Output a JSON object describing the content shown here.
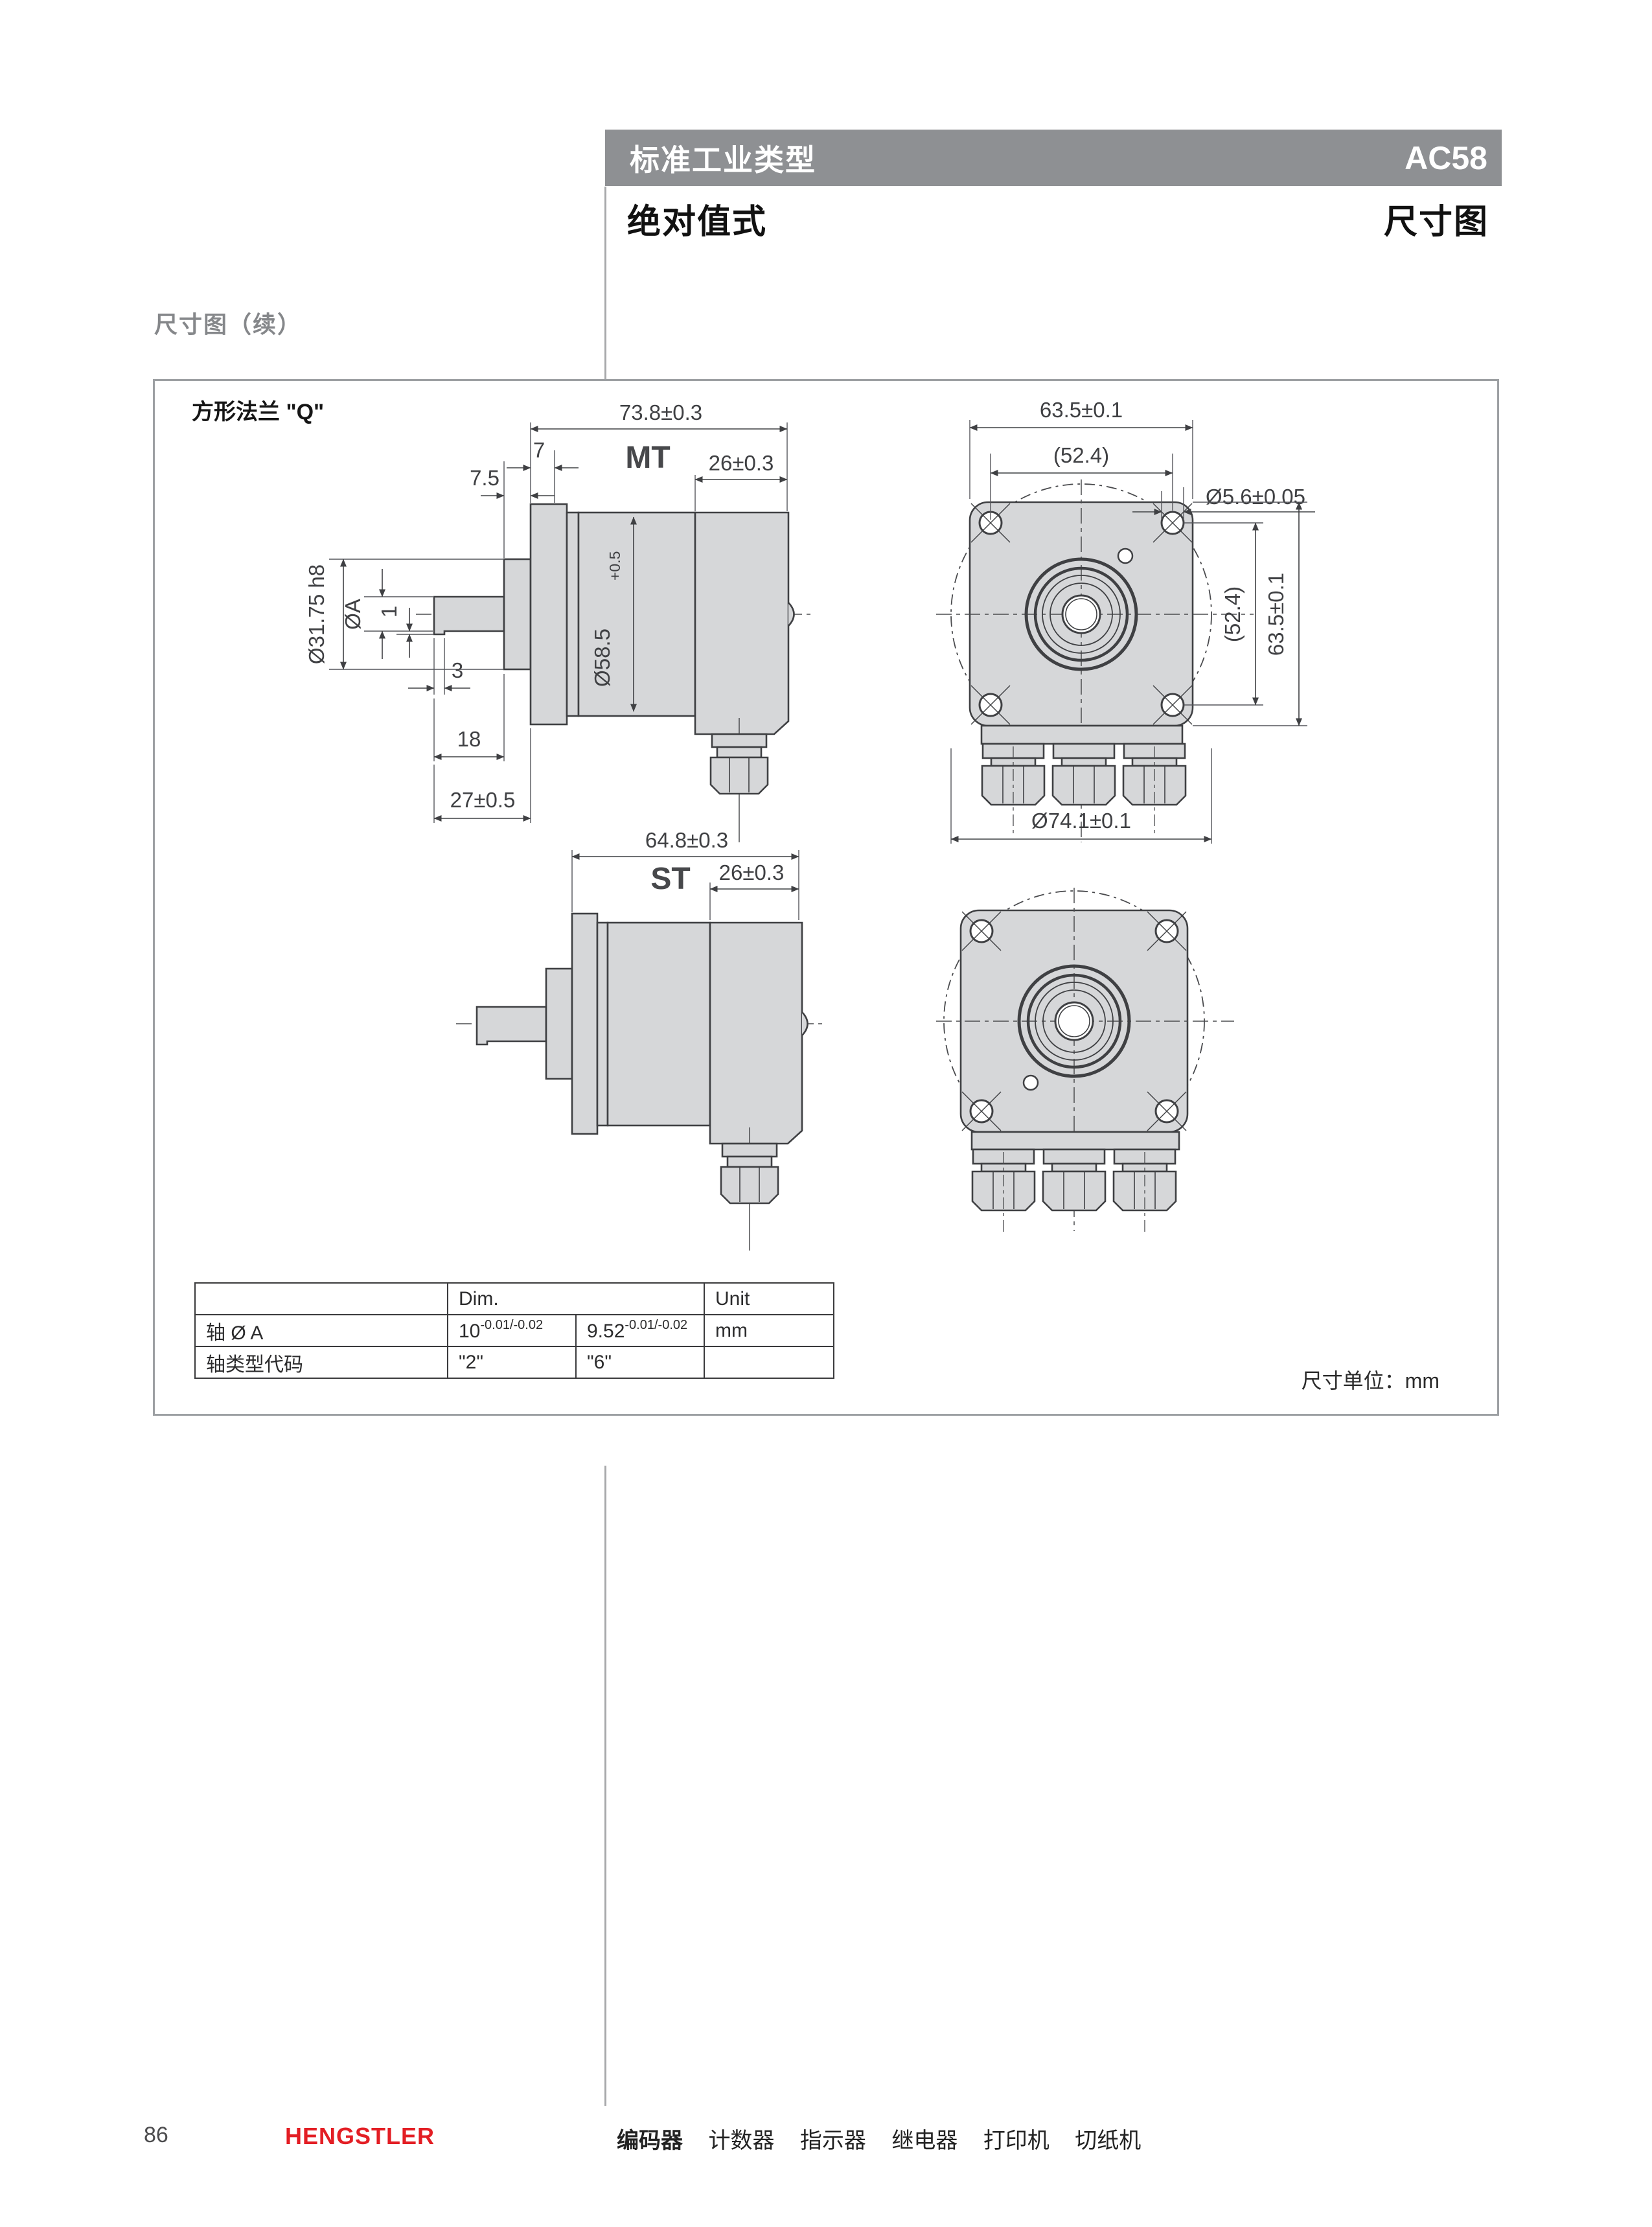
{
  "header": {
    "bar_title": "标准工业类型",
    "product_code": "AC58",
    "subtitle": "绝对值式",
    "page_type": "尺寸图"
  },
  "section": {
    "title": "尺寸图（续）"
  },
  "figure": {
    "title": "方形法兰 \"Q\"",
    "unit_note": "尺寸单位：mm",
    "labels": {
      "mt": "MT",
      "st": "ST"
    },
    "dims": {
      "mt_length": "73.8±0.3",
      "mt_rear": "26±0.3",
      "flange_thickness": "7",
      "hub_depth": "7.5",
      "collar_dia": "Ø31.75 h8",
      "shaft_dia": "ØA",
      "step_height": "1",
      "step_length": "3",
      "shaft_length": "18",
      "front_length": "27±0.5",
      "body_dia": "Ø58.5",
      "body_dia_tol": "+0.5",
      "st_length": "64.8±0.3",
      "st_rear": "26±0.3",
      "flange_width": "63.5±0.1",
      "hole_pitch_w": "(52.4)",
      "hole_dia": "Ø5.6±0.05",
      "hole_pitch_h": "(52.4)",
      "flange_height": "63.5±0.1",
      "body_circle": "Ø74.1±0.1"
    }
  },
  "table": {
    "header": {
      "dim": "Dim.",
      "unit": "Unit"
    },
    "row1": {
      "label": "轴 Ø A",
      "v1": "10",
      "v1_sup": "-0.01/-0.02",
      "v2": "9.52",
      "v2_sup": "-0.01/-0.02",
      "unit": "mm"
    },
    "row2": {
      "label": "轴类型代码",
      "v1": "\"2\"",
      "v2": "\"6\""
    }
  },
  "footer": {
    "page_number": "86",
    "brand": "HENGSTLER",
    "products": [
      "编码器",
      "计数器",
      "指示器",
      "继电器",
      "打印机",
      "切纸机"
    ]
  }
}
